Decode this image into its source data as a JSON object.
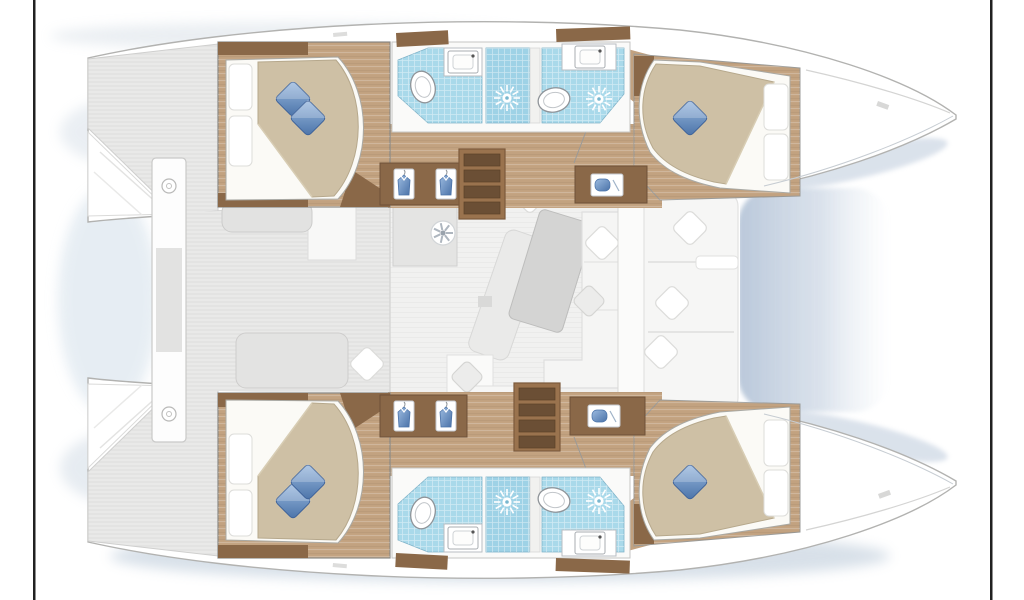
{
  "document": {
    "type": "catamaran-floor-plan",
    "view": "overhead interior deck plan",
    "bow_direction": "right",
    "visible_text": []
  },
  "palette": {
    "frame": "#212121",
    "hullFill": "#ffffff",
    "hullStroke": "#b2b2b0",
    "deck": "#e9e9e8",
    "salonFloor": "#f1f1f0",
    "wood": "#c2a280",
    "woodDark": "#8a6848",
    "stepFrame": "#9a734e",
    "tread": "#6b4f35",
    "tile": "#a9d9ea",
    "tileShower": "#9ed2e6",
    "duvet": "#cec0a5",
    "bedSheet": "#fbfaf6",
    "sofa": "#f5f5f4",
    "bench": "#e2e2e1",
    "shadowBlue": "#aebfd4",
    "pillowBlueLight": "#9cbbe0",
    "pillowBlueDark": "#4a72a8",
    "fixtureStroke": "#8f9499"
  },
  "floor_plan": {
    "hulls": [
      {
        "id": "upper-hull",
        "rooms": [
          {
            "name": "upper-aft-cabin",
            "items": [
              "island-double-berth",
              "two-white-pillows",
              "two-blue-cushions",
              "wood-sole",
              "dark-trim"
            ]
          },
          {
            "name": "upper-aft-head",
            "items": [
              "toilet",
              "washbasin",
              "shower-sunburst",
              "blue-tile-floor"
            ]
          },
          {
            "name": "upper-forward-head",
            "items": [
              "toilet",
              "washbasin",
              "shower-sunburst",
              "blue-tile-floor"
            ]
          },
          {
            "name": "upper-forward-cabin",
            "items": [
              "island-double-berth",
              "two-white-pillows",
              "blue-cushion",
              "wood-sole"
            ]
          },
          {
            "name": "upper-corridor",
            "items": [
              "companionway-steps",
              "hanging-locker-two-shirts",
              "vanity-cabinet"
            ]
          },
          {
            "name": "upper-stern",
            "items": [
              "swim-platform",
              "side-deck"
            ]
          }
        ]
      },
      {
        "id": "lower-hull",
        "rooms": [
          {
            "name": "lower-aft-cabin",
            "items": [
              "island-double-berth",
              "two-white-pillows",
              "two-blue-cushions",
              "wood-sole",
              "dark-trim"
            ]
          },
          {
            "name": "lower-aft-head",
            "items": [
              "toilet",
              "washbasin",
              "shower-sunburst",
              "blue-tile-floor"
            ]
          },
          {
            "name": "lower-forward-head",
            "items": [
              "toilet",
              "washbasin",
              "shower-sunburst",
              "blue-tile-floor"
            ]
          },
          {
            "name": "lower-forward-cabin",
            "items": [
              "island-double-berth",
              "two-white-pillows",
              "blue-cushion",
              "wood-sole"
            ]
          },
          {
            "name": "lower-corridor",
            "items": [
              "companionway-steps",
              "hanging-locker-two-shirts",
              "vanity-cabinet"
            ]
          },
          {
            "name": "lower-stern",
            "items": [
              "swim-platform",
              "side-deck"
            ]
          }
        ]
      }
    ],
    "bridgedeck": {
      "aft_cockpit": [
        "cockpit-bench",
        "cockpit-seat-with-cushion",
        "davit-beam"
      ],
      "salon": [
        "galley-block",
        "cooktop-vent-fan",
        "tilted-dining-table",
        "bench-cushion",
        "l-shaped-sofa",
        "white-cabinets",
        "scatter-cushions"
      ],
      "forward_cockpit": [
        "lounge-seat",
        "three-diamond-cushions",
        "armrest"
      ],
      "shadows": [
        "bridgedeck-shadow-between-bows",
        "hull-ambient-shadows"
      ]
    },
    "icon_legend": {
      "shower": "sunburst-drain-icon",
      "toilet": "oval-bowl-icon",
      "washbasin": "rect-basin-icon",
      "locker": "shirt-on-hanger-icon",
      "vent": "fan-spoke-icon",
      "cushion": "diamond-pillow-icon"
    },
    "counts": {
      "cabins": 4,
      "heads": 4,
      "showers": 4,
      "toilets": 4,
      "washbasins": 4,
      "companionway_steps": 2
    }
  }
}
